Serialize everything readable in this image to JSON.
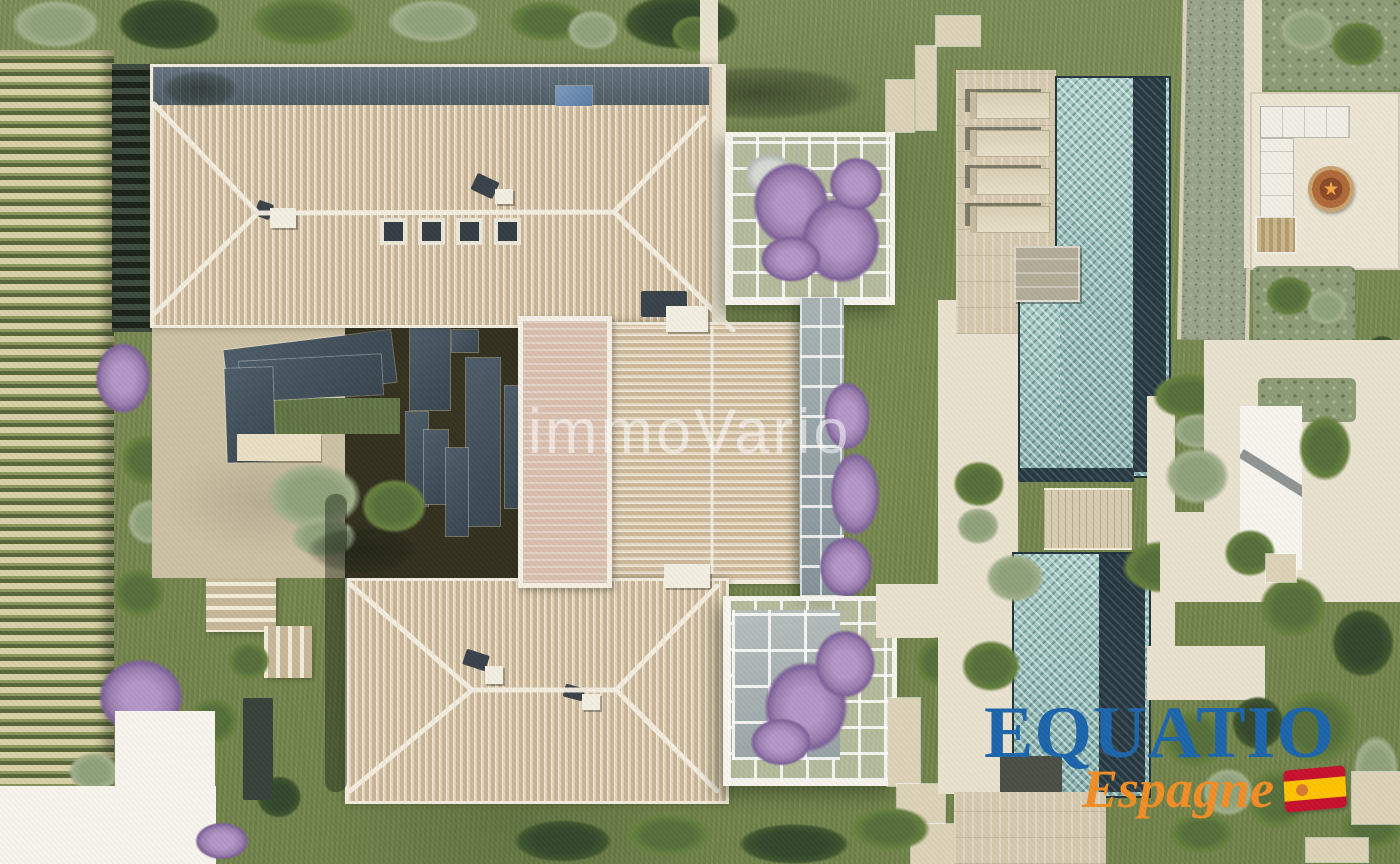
{
  "watermark": {
    "text": "immoVario",
    "color": "#ffffff",
    "opacity": 0.55
  },
  "logo": {
    "name": "EQUATIO",
    "region": "Espagne",
    "name_color": "#1d65ab",
    "region_color": "#f28e26",
    "flag_icon": "spanish-flag-icon",
    "flag_red": "#c8102e",
    "flag_yellow": "#ffc400"
  },
  "palette": {
    "grass": "#7c8d55",
    "roof_tile": "#d9c6a9",
    "roof_ridge_white": "#f4efe2",
    "roof_slate_band": "#51626e",
    "flat_roof_tower": "#d9bfae",
    "pool_water": "#9fc3bd",
    "pool_dark_edge": "#26363f",
    "stone_deck": "#d5c9ae",
    "pale_path": "#e9e2cf",
    "vineyard_light": "#d8d0a6",
    "vineyard_green": "#59673c",
    "bougainvillea": "#9c7fb0",
    "fire_pit_rust": "#b06a3a"
  },
  "scene": {
    "type": "aerial-architectural-rendering",
    "elements": [
      "vineyard-rows",
      "villa-tiled-roofs",
      "rooftop-tower",
      "inner-courtyard",
      "solar-panels",
      "bougainvillea-pergolas",
      "glass-corridor",
      "lap-pool",
      "sun-loungers",
      "pool-deck-bridge",
      "gravel-stream",
      "fire-pit-terrace",
      "garden-stairs",
      "purple-trees",
      "garden-shrubs"
    ]
  }
}
